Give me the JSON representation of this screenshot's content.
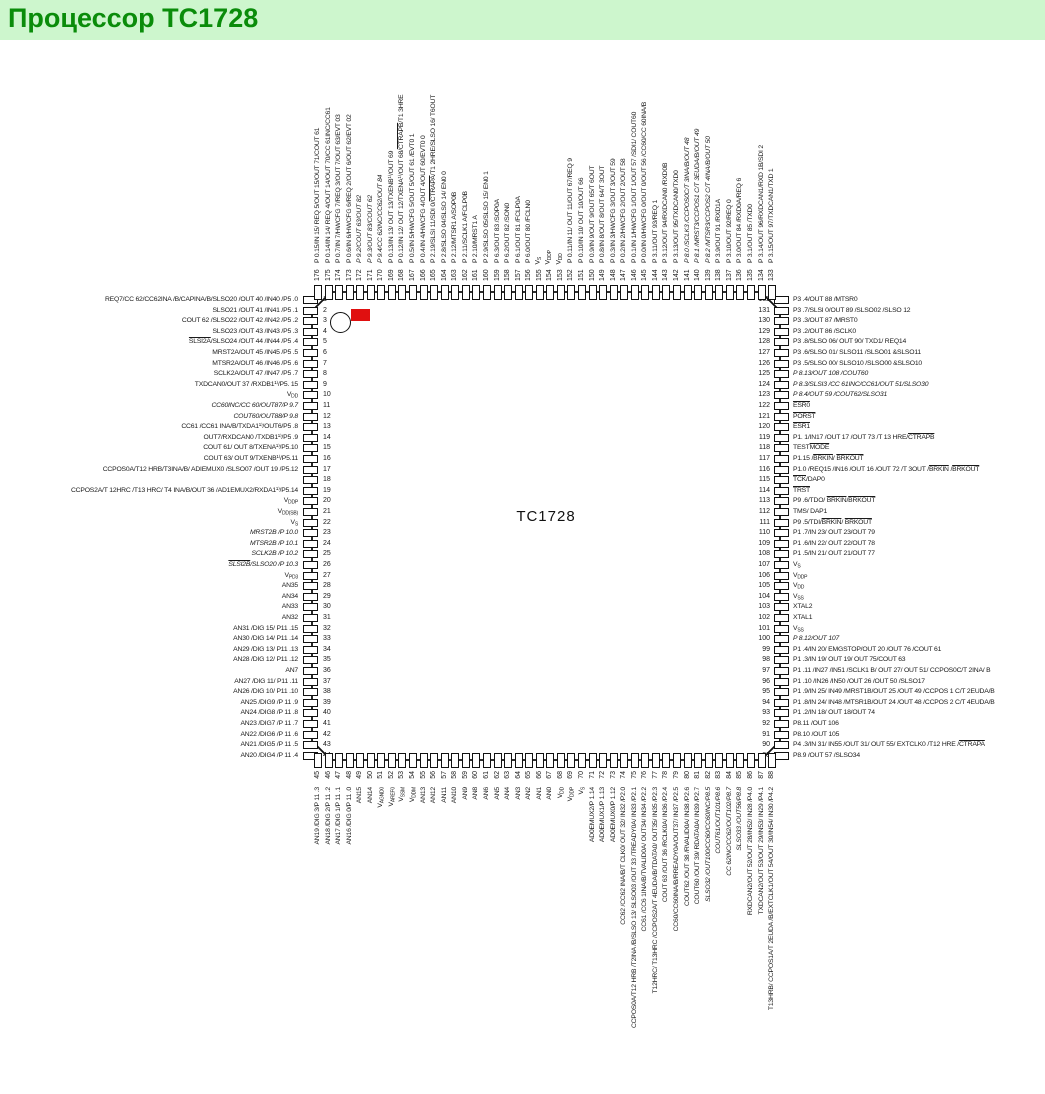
{
  "page": {
    "title": "Процессор TC1728"
  },
  "chip": {
    "label": "TC1728"
  },
  "colors": {
    "header_bg": "#cdf6cd",
    "header_text": "#0a8c0a",
    "marker_red": "#e01010",
    "outline": "#111111"
  },
  "pins": {
    "left": [
      {
        "n": 1,
        "label": "REQ7/CC 62/CC62INA /B/CAPINA/B/SLSO20 /OUT 40 /IN40 /P5 .0"
      },
      {
        "n": 2,
        "label": "SLSO21 /OUT 41 /IN41 /P5 .1"
      },
      {
        "n": 3,
        "label": "COUT 62 /SLSO22 /OUT 42 /IN42 /P5 .2"
      },
      {
        "n": 4,
        "label": "SLSO23 /OUT 43 /IN43 /P5 .3"
      },
      {
        "n": 5,
        "label": "{SLSI2A}/SLSO24 /OUT 44 /IN44 /P5 .4"
      },
      {
        "n": 6,
        "label": "MRST2A/OUT 45 /IN45 /P5 .5"
      },
      {
        "n": 7,
        "label": "MTSR2A/OUT 46 /IN46 /P5 .6"
      },
      {
        "n": 8,
        "label": "SCLK2A/OUT 47 /IN47 /P5 .7"
      },
      {
        "n": 9,
        "label": "TXDCAN0/OUT 37 /RXDB1¹⁾/P5. 15"
      },
      {
        "n": 10,
        "label": "V~DD~"
      },
      {
        "n": 11,
        "label": "CC60INC/CC 60/OUT87/P 9.7",
        "i": true
      },
      {
        "n": 12,
        "label": "COUT60/OUT88/P 9.8",
        "i": true
      },
      {
        "n": 13,
        "label": "CC61 /CC61 INA/B/TXDA1¹⁾/OUT6/P5 .8"
      },
      {
        "n": 14,
        "label": "OUT7/RXDCAN0 /TXDB1¹⁾/P5 .9"
      },
      {
        "n": 15,
        "label": "COUT 61/ OUT 8/TXENA¹⁾/P5.10"
      },
      {
        "n": 16,
        "label": "COUT 63/ OUT 9/TXENB¹⁾/P5.11"
      },
      {
        "n": 17,
        "label": "CCPOS0A/T12 HRB/T3INA/B/ ADIEMUX0 /SLSO07 /OUT 19 /P5.12"
      },
      {
        "n": 18,
        "label": ""
      },
      {
        "n": 19,
        "label": "CCPOS2A/T 12HRC /T13 HRC/ T4 INA/B/OUT 36 /AD1EMUX2/RXDA1¹⁾/P5.14"
      },
      {
        "n": 20,
        "label": "V~DDP~"
      },
      {
        "n": 21,
        "label": "V~DD(SB)~"
      },
      {
        "n": 22,
        "label": "V~S~"
      },
      {
        "n": 23,
        "label": "MRST2B /P 10.0",
        "i": true
      },
      {
        "n": 24,
        "label": "MTSR2B /P 10.1",
        "i": true
      },
      {
        "n": 25,
        "label": "SCLK2B /P 10.2",
        "i": true
      },
      {
        "n": 26,
        "label": "{SLSI2B}/SLSO20 /P 10.3",
        "i": true
      },
      {
        "n": 27,
        "label": "V~PD3~"
      },
      {
        "n": 28,
        "label": "AN35"
      },
      {
        "n": 29,
        "label": "AN34"
      },
      {
        "n": 30,
        "label": "AN33"
      },
      {
        "n": 31,
        "label": "AN32"
      },
      {
        "n": 32,
        "label": "AN31 /DIG 15/ P11 .15"
      },
      {
        "n": 33,
        "label": "AN30 /DIG 14/ P11 .14"
      },
      {
        "n": 34,
        "label": "AN29 /DIG 13/ P11 .13"
      },
      {
        "n": 35,
        "label": "AN28 /DIG 12/ P11 .12"
      },
      {
        "n": 36,
        "label": "AN7"
      },
      {
        "n": 37,
        "label": "AN27 /DIG 11/ P11 .11"
      },
      {
        "n": 38,
        "label": "AN26 /DIG 10/ P11 .10"
      },
      {
        "n": 39,
        "label": "AN25 /DIG9 /P 11 .9"
      },
      {
        "n": 40,
        "label": "AN24 /DIG8 /P 11 .8"
      },
      {
        "n": 41,
        "label": "AN23 /DIG7 /P 11 .7"
      },
      {
        "n": 42,
        "label": "AN22 /DIG6 /P 11 .6"
      },
      {
        "n": 43,
        "label": "AN21 /DIG5 /P 11 .5"
      },
      {
        "n": 44,
        "label": "AN20 /DIG4 /P 11 .4"
      }
    ],
    "top": [
      {
        "n": 176,
        "label": "P 0.15/IN 15/ REQ 5/OUT 15/OUT 71/COUT 61"
      },
      {
        "n": 175,
        "label": "P 0.14/IN 14/ REQ 4/OUT 14/OUT 70/CC 61INC/CC61"
      },
      {
        "n": 174,
        "label": "P 0.7/IN 7/HWCFG 7/REQ 3/OUT 7/OUT 63/EVT 03"
      },
      {
        "n": 173,
        "label": "P 0.6/IN 6/HWCFG 6/REQ 2/OUT 6/OUT 62/EVT 02"
      },
      {
        "n": 172,
        "label": "P 9.2/COUT 63/OUT 82",
        "i": true
      },
      {
        "n": 171,
        "label": "P 9.3/OUT 83/COUT 62",
        "i": true
      },
      {
        "n": 170,
        "label": "P 9.4/CC 62INC/CC62/OUT 84",
        "i": true
      },
      {
        "n": 169,
        "label": "P 0.13/IN 13/ OUT 13/TXENB¹⁾/OUT 69"
      },
      {
        "n": 168,
        "label": "P 0.12/IN 12/ OUT 12/TXENA¹⁾/OUT 68/{CTRAPB}/T1 3HRE"
      },
      {
        "n": 167,
        "label": "P 0.5/IN 5/HWCFG 5/OUT 5/OUT 61 /EVT0 1"
      },
      {
        "n": 166,
        "label": "P 0.4/IN 4/HWCFG 4/OUT 4/OUT 60/EVT0 0"
      },
      {
        "n": 165,
        "label": "P 2.19/SLSI 11/SDI 0/{CTRAPA}/T1 2HRE/SLSO 16/ T6OUT"
      },
      {
        "n": 164,
        "label": "P 2.8/SLSO 04/SLSO 14/ EN0 0"
      },
      {
        "n": 163,
        "label": "P 2.12/MTSR1 A/SOP0B"
      },
      {
        "n": 162,
        "label": "P 2.11/SCLK1 A/FCLP0B"
      },
      {
        "n": 161,
        "label": "P 2.10/MRST1 A"
      },
      {
        "n": 160,
        "label": "P 2.9/SLSO 05/SLSO 15/ EN0 1"
      },
      {
        "n": 159,
        "label": "P 6.3/OUT 83 /SOP0A"
      },
      {
        "n": 158,
        "label": "P 6.2/OUT 82 /SON0"
      },
      {
        "n": 157,
        "label": "P 6.1/OUT 81 /FCLP0A"
      },
      {
        "n": 156,
        "label": "P 6.0/OUT 80 /FCLN0"
      },
      {
        "n": 155,
        "label": "V~S~"
      },
      {
        "n": 154,
        "label": "V~DDP~"
      },
      {
        "n": 153,
        "label": "V~DD~"
      },
      {
        "n": 152,
        "label": "P 0.11/IN 11/ OUT 11/OUT 67/REQ 9"
      },
      {
        "n": 151,
        "label": "P 0.10/IN 10/ OUT 10/OUT 66"
      },
      {
        "n": 150,
        "label": "P 0.9/IN 9/OUT 9/OUT 65/T 6OUT"
      },
      {
        "n": 149,
        "label": "P 0.8/IN 8/OUT 8/OUT 64/T 3OUT"
      },
      {
        "n": 148,
        "label": "P 0.3/IN 3/HWCFG 3/OUT 3/OUT 59"
      },
      {
        "n": 147,
        "label": "P 0.2/IN 2/HWCFG 2/OUT 2/OUT 58"
      },
      {
        "n": 146,
        "label": "P 0.1/IN 1/HWCFG 1/OUT 1/OUT 57 /SDI1/ COUT60"
      },
      {
        "n": 145,
        "label": "P 0.0/IN 0/HWCFG 0/OUT 0/OUT 56 /CC60/CC 60INA/B"
      },
      {
        "n": 144,
        "label": "P 3.11/OUT 93/REQ 1"
      },
      {
        "n": 143,
        "label": "P 3.12/OUT 94/RXDCAN0 /RXD0B"
      },
      {
        "n": 142,
        "label": "P 3.13/OUT 95/TXDCAN0/TXD0"
      },
      {
        "n": 141,
        "label": "P 8.0 /SCLK3 /CCPOS0C/T 3INA/B/OUT 48",
        "i": true
      },
      {
        "n": 140,
        "label": "P 8.1 /MRST3/CCPOS1 C/T 3EUDA/B/OUT 49",
        "i": true
      },
      {
        "n": 139,
        "label": "P 8.2 /MTSR3/CCPOS2 C/T 4INA/B/OUT 50",
        "i": true
      },
      {
        "n": 138,
        "label": "P 3.9/OUT 91 /RXD1A"
      },
      {
        "n": 137,
        "label": "P 3.10/OUT 92/REQ 0"
      },
      {
        "n": 136,
        "label": "P 3.0/OUT 84 /RXD0A/REQ 6"
      },
      {
        "n": 135,
        "label": "P 3.1/OUT 85 /TXD0"
      },
      {
        "n": 134,
        "label": "P 3.14/OUT 96/RXDCAN1/RXD 1B/SDI 2"
      },
      {
        "n": 133,
        "label": "P 3.15/OUT 97/TXDCAN1/TXD 1"
      }
    ],
    "right": [
      {
        "n": 132,
        "label": "P3 .4/OUT 88 /MTSR0"
      },
      {
        "n": 131,
        "label": "P3 .7/SLSI 0/OUT 89 /SLSO02 /SLSO 12"
      },
      {
        "n": 130,
        "label": "P3 .3/OUT 87 /MRST0"
      },
      {
        "n": 129,
        "label": "P3 .2/OUT 86 /SCLK0"
      },
      {
        "n": 128,
        "label": "P3 .8/SLSO 06/ OUT 90/ TXD1/ REQ14"
      },
      {
        "n": 127,
        "label": "P3 .6/SLSO 01/ SLSO11 /SLSO01 &SLSO11"
      },
      {
        "n": 126,
        "label": "P3 .5/SLSO 00/ SLSO10 /SLSO00 &SLSO10"
      },
      {
        "n": 125,
        "label": "P 8.13/OUT 108 /COUT60",
        "i": true
      },
      {
        "n": 124,
        "label": "P 8.3/SLSI3 /CC 61INC/CC61/OUT 51/SLSO30",
        "i": true
      },
      {
        "n": 123,
        "label": "P 8.4/OUT 59 /COUT62/SLSO31",
        "i": true
      },
      {
        "n": 122,
        "label": "{ESR0}"
      },
      {
        "n": 121,
        "label": "{PORST}"
      },
      {
        "n": 120,
        "label": "{ESR1}"
      },
      {
        "n": 119,
        "label": "P1. 1/IN17 /OUT 17 /OUT 73 /T 13 HRE/{CTRAPB}"
      },
      {
        "n": 118,
        "label": "TEST{MODE}"
      },
      {
        "n": 117,
        "label": "P1.15 /{BRKIN}/ {BRKOUT}"
      },
      {
        "n": 116,
        "label": "P1.0 /REQ15 /IN16 /OUT 16 /OUT 72 /T 3OUT /{BRKIN} /{BRKOUT}"
      },
      {
        "n": 115,
        "label": "{TCK}/DAP0"
      },
      {
        "n": 114,
        "label": "{TRST}"
      },
      {
        "n": 113,
        "label": "P9 .6/TDO/ {BRKIN}/{BRKOUT}"
      },
      {
        "n": 112,
        "label": "TMS/ DAP1"
      },
      {
        "n": 111,
        "label": "P9 .5/TDI/{BRKIN}/ {BRKOUT}"
      },
      {
        "n": 110,
        "label": "P1 .7/IN 23/ OUT 23/OUT 79"
      },
      {
        "n": 109,
        "label": "P1 .6/IN 22/ OUT 22/OUT 78"
      },
      {
        "n": 108,
        "label": "P1 .5/IN 21/ OUT 21/OUT 77"
      },
      {
        "n": 107,
        "label": "V~S~"
      },
      {
        "n": 106,
        "label": "V~DDP~"
      },
      {
        "n": 105,
        "label": "V~DD~"
      },
      {
        "n": 104,
        "label": "V~SS~"
      },
      {
        "n": 103,
        "label": "XTAL2"
      },
      {
        "n": 102,
        "label": "XTAL1"
      },
      {
        "n": 101,
        "label": "V~SS~"
      },
      {
        "n": 100,
        "label": "P 8.12/OUT 107",
        "i": true
      },
      {
        "n": 99,
        "label": "P1 .4/IN 20/ EMGSTOP/OUT 20 /OUT 76 /COUT 61"
      },
      {
        "n": 98,
        "label": "P1 .3/IN 19/ OUT 19/ OUT 75/COUT 63"
      },
      {
        "n": 97,
        "label": "P1 .11 /IN27 /IN51 /SCLK1 B/ OUT 27/ OUT 51/ CCPOS0C/T 2INA/ B"
      },
      {
        "n": 96,
        "label": "P1 .10 /IN26 /IN50 /OUT 26 /OUT 50 /SLSO17"
      },
      {
        "n": 95,
        "label": "P1 .9/IN 25/ IN49 /MRST1B/OUT 25 /OUT 49 /CCPOS 1 C/T 2EUDA/B"
      },
      {
        "n": 94,
        "label": "P1 .8/IN 24/ IN48 /MTSR1B/OUT 24 /OUT 48 /CCPOS 2 C/T 4EUDA/B"
      },
      {
        "n": 93,
        "label": "P1 .2/IN 18/ OUT 18/OUT 74"
      },
      {
        "n": 92,
        "label": "P8.11 /OUT 106"
      },
      {
        "n": 91,
        "label": "P8.10 /OUT 105"
      },
      {
        "n": 90,
        "label": "P4 .3/IN 31/ IN55 /OUT 31/ OUT 55/ EXTCLK0 /T12 HRE /{CTRAPA}"
      },
      {
        "n": 89,
        "label": "P8.9 /OUT 57 /SLSO34"
      }
    ],
    "bottom": [
      {
        "n": 45,
        "label": "AN19 /DIG 3/P 11 .3"
      },
      {
        "n": 46,
        "label": "AN18 /DIG 2/P 11 .2"
      },
      {
        "n": 47,
        "label": "AN17 /DIG 1/P 11 .1"
      },
      {
        "n": 48,
        "label": "AN16 /DIG 0/P 11 .0"
      },
      {
        "n": 49,
        "label": "AN15"
      },
      {
        "n": 50,
        "label": "AN14"
      },
      {
        "n": 51,
        "label": "V~AGND0~"
      },
      {
        "n": 52,
        "label": "V~AREF0~"
      },
      {
        "n": 53,
        "label": "V~SSM~"
      },
      {
        "n": 54,
        "label": "V~DDM~"
      },
      {
        "n": 55,
        "label": "AN13"
      },
      {
        "n": 56,
        "label": "AN12"
      },
      {
        "n": 57,
        "label": "AN11"
      },
      {
        "n": 58,
        "label": "AN10"
      },
      {
        "n": 59,
        "label": "AN9"
      },
      {
        "n": 60,
        "label": "AN8"
      },
      {
        "n": 61,
        "label": "AN6"
      },
      {
        "n": 62,
        "label": "AN5"
      },
      {
        "n": 63,
        "label": "AN4"
      },
      {
        "n": 64,
        "label": "AN3"
      },
      {
        "n": 65,
        "label": "AN2"
      },
      {
        "n": 66,
        "label": "AN1"
      },
      {
        "n": 67,
        "label": "AN0"
      },
      {
        "n": 68,
        "label": "V~DD~"
      },
      {
        "n": 69,
        "label": "V~DDP~"
      },
      {
        "n": 70,
        "label": "V~S~"
      },
      {
        "n": 71,
        "label": "AD0EMUX2/P 1.14"
      },
      {
        "n": 72,
        "label": "AD0EMUX1/P 1.13"
      },
      {
        "n": 73,
        "label": "AD0EMUX0/P 1.12"
      },
      {
        "n": 74,
        "label": "CC62 /CC62 INA/B/T CLK0/ OUT 32/ IN32 /P2.0"
      },
      {
        "n": 75,
        "label": "CCPOS0A/T12 HRB /T2INA /B/SLSO 13/ SLSO03 /OUT 33 /TREADY0A/ IN33 /P2.1"
      },
      {
        "n": 76,
        "label": "CC61 /CC6 1INA/B/TVALID0A/ OUT34/ IN34 /P2.2"
      },
      {
        "n": 77,
        "label": "T12HRC/ T13HRC /CCPOS2A/T 4EUDA/B/TDATA0/ OUT35/ IN35 /P2.3"
      },
      {
        "n": 78,
        "label": "COUT 63 /OUT 36 /RCLK0A/ IN36 /P2.4"
      },
      {
        "n": 79,
        "label": "CC60/CC60INA/B/RREADY0A/OUT37/ IN37 /P2.5"
      },
      {
        "n": 80,
        "label": "COUT62 /OUT 38 /RVALID0A/ IN38 /P2.6"
      },
      {
        "n": 81,
        "label": "COUT60 /OUT 39/ RDATA0A/ IN39 /P2.7"
      },
      {
        "n": 82,
        "label": "SLSO32 /OUT100/CC60/CC60INC/P8.5",
        "i": true
      },
      {
        "n": 83,
        "label": "COUT61/OUT101/P8.6",
        "i": true
      },
      {
        "n": 84,
        "label": "CC 62INC/CC62/OUT102/P8.7",
        "i": true
      },
      {
        "n": 85,
        "label": "SLSO33 /OUT56/P8.8",
        "i": true
      },
      {
        "n": 86,
        "label": "RXDCAN2/OUT 52/OUT 28/IN52/ IN28 /P4.0"
      },
      {
        "n": 87,
        "label": "TXDCAN2/OUT 53/OUT 29/IN53/ IN29 /P4.1"
      },
      {
        "n": 88,
        "label": "T13HRB/ CCPOS1A/T 2EUDA /B/EXTCLK1/OUT 54/OUT 30/IN54/ IN30 /P4.2"
      }
    ]
  }
}
